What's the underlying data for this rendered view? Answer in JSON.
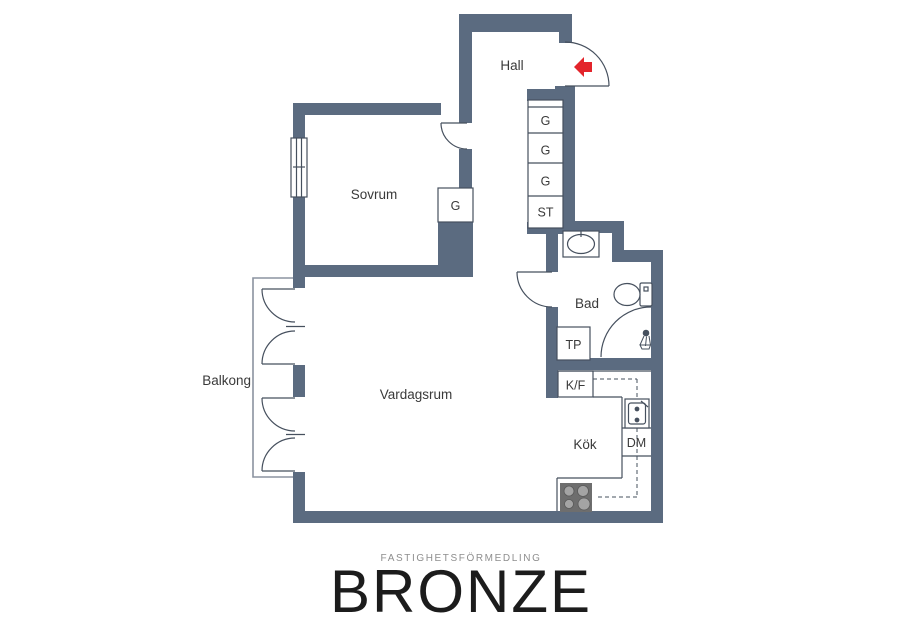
{
  "floorplan": {
    "labels": {
      "hall": "Hall",
      "sovrum": "Sovrum",
      "vardagsrum": "Vardagsrum",
      "balkong": "Balkong",
      "kok": "Kök",
      "bad": "Bad",
      "g1": "G",
      "g2": "G",
      "g3": "G",
      "st": "ST",
      "g_sovrum": "G",
      "tp": "TP",
      "kf": "K/F",
      "dm": "DM"
    },
    "colors": {
      "wall": "#5b6b80",
      "line": "#46505e",
      "balcony_outline": "#8b93a0",
      "entrance_arrow": "#e3242b",
      "stove_body": "#6e6e6e",
      "stove_burner": "#a4a4a4"
    },
    "icons": {
      "entrance": "entrance-arrow-icon",
      "window": "window-icon",
      "bath_sink": "bath-sink-icon",
      "toilet": "toilet-icon",
      "shower": "shower-icon",
      "kitchen_sink": "kitchen-sink-icon",
      "stove": "stove-icon"
    }
  },
  "branding": {
    "tagline": "FASTIGHETSFÖRMEDLING",
    "name": "BRONZE"
  }
}
